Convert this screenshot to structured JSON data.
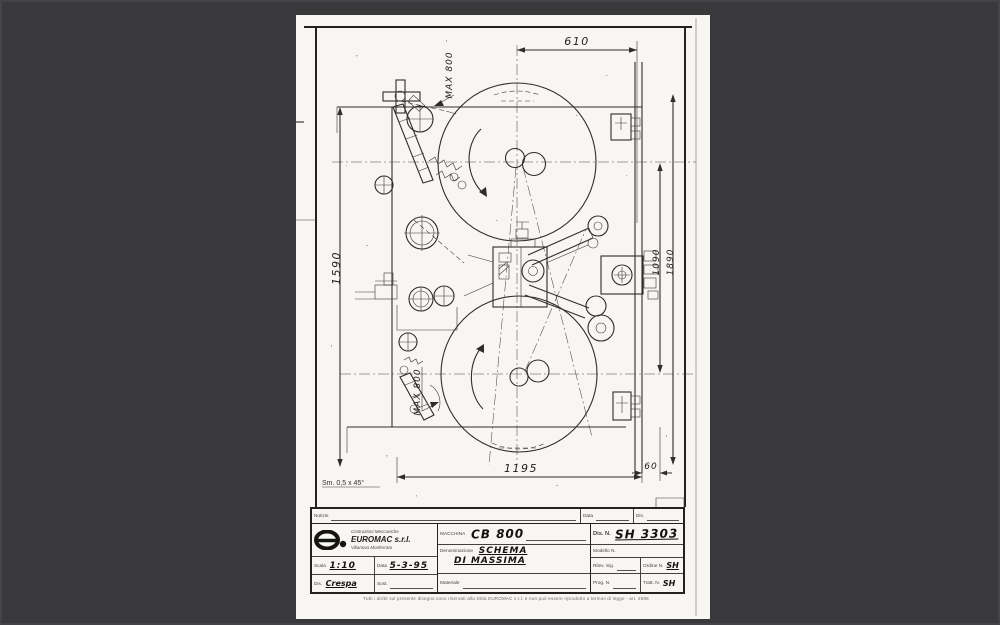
{
  "drawing": {
    "dims": {
      "d610": "610",
      "d1195": "1195",
      "d60": "60",
      "d1590": "1590",
      "d1090": "1090",
      "d1890": "1890",
      "max_top": "MAX 800",
      "max_bottom": "MAX 800"
    },
    "note_chamfer": "Sm. 0,5 x 45°"
  },
  "title_block": {
    "notes_label": "Notizie",
    "top_data_label": "Data",
    "top_dis_label": "Dis.",
    "company": {
      "line1": "Costruzioni Meccaniche",
      "name": "EUROMAC s.r.l.",
      "line3": "Villanova Monferrato"
    },
    "scala_label": "Scala",
    "scala_value": "1:10",
    "data_label": "Data",
    "data_value": "5-3-95",
    "dis_label": "Dis.",
    "dis_value": "Crespa",
    "sost_label": "Sost.",
    "macchina_label": "MACCHINA",
    "macchina_value": "CB 800",
    "denominazione_label": "Denominazione",
    "denominazione_value1": "SCHEMA",
    "denominazione_value2": "DI MASSIMA",
    "materiale_label": "Materiale",
    "dis_n_label": "Dis. N.",
    "dis_n_value": "SH 3303",
    "modello_label": "Modello N.",
    "rilev_label": "Rilev. Sig.",
    "ordine_label": "Ordine N.",
    "ordine_value": "SH",
    "prog_label": "Prog. N.",
    "tratt_label": "Tratt. N.",
    "tratt_value": "SH",
    "fine_print": "Tutti i diritti sul presente disegno sono riservati alla Ditta EUROMAC s.r.l. e non può essere riprodotto a termini di legge - art. 2598"
  }
}
